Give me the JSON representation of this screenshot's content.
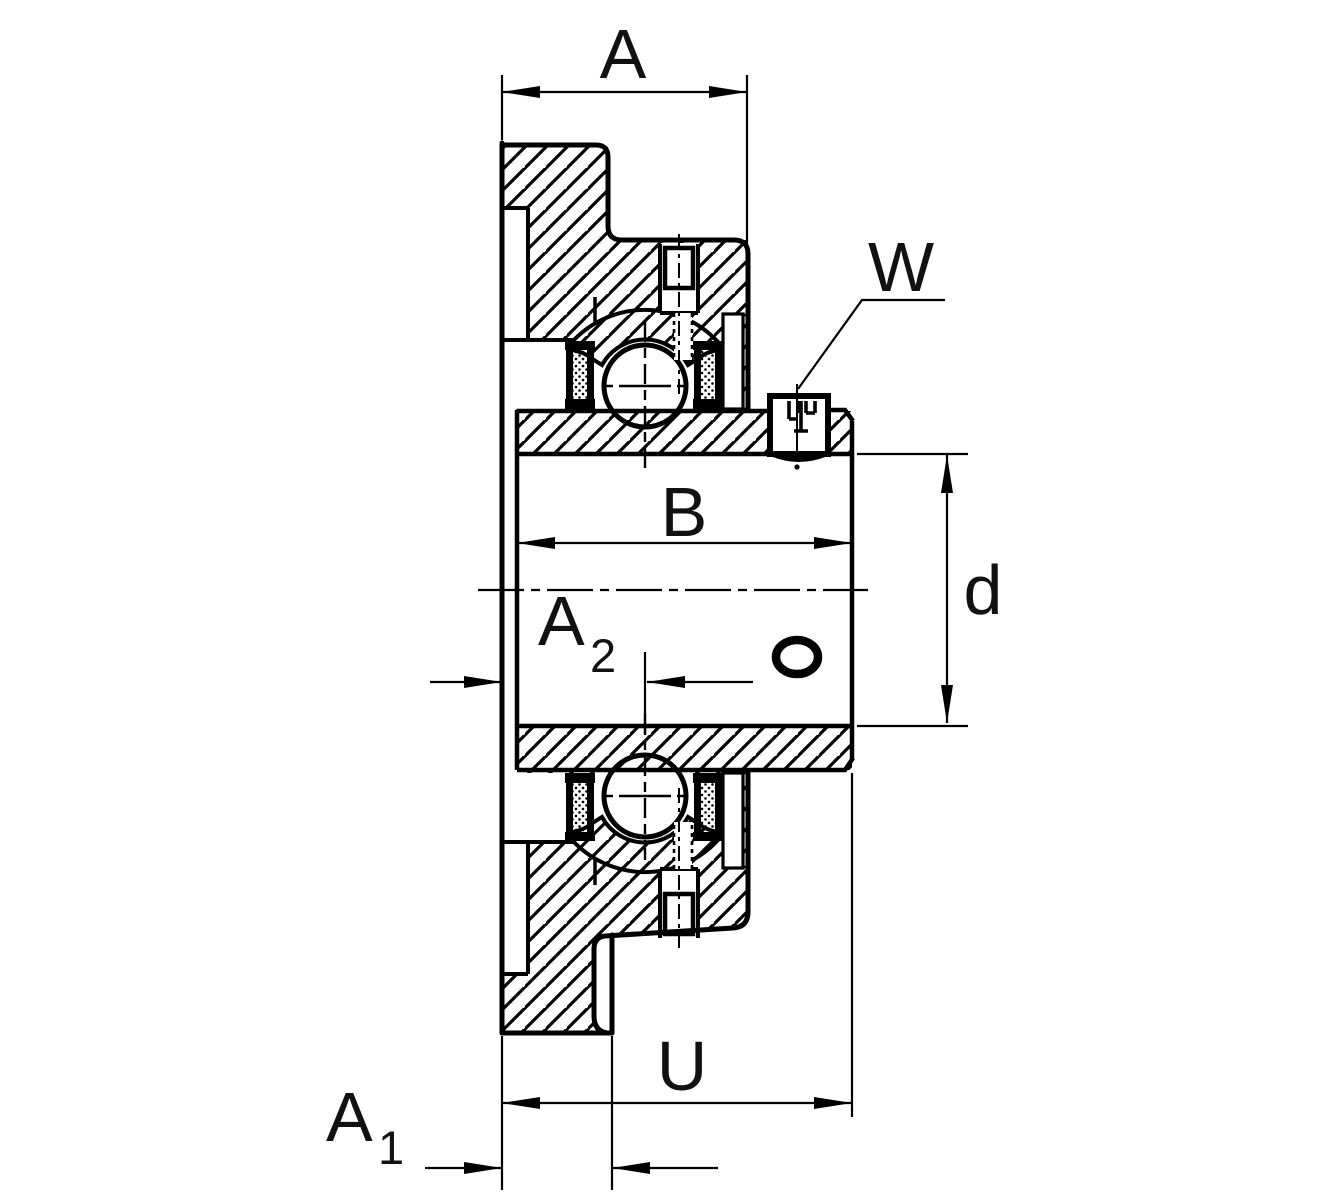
{
  "drawing": {
    "title": "Flanged bearing housing unit - sectional drawing",
    "background_color": "#ffffff",
    "line_color": "#000000",
    "dimensions": {
      "a": {
        "label": "A"
      },
      "w": {
        "label": "W"
      },
      "b": {
        "label": "B"
      },
      "d": {
        "label": "d"
      },
      "a2": {
        "label": "A",
        "sub": "2"
      },
      "u": {
        "label": "U"
      },
      "a1": {
        "label": "A",
        "sub": "1"
      }
    }
  }
}
